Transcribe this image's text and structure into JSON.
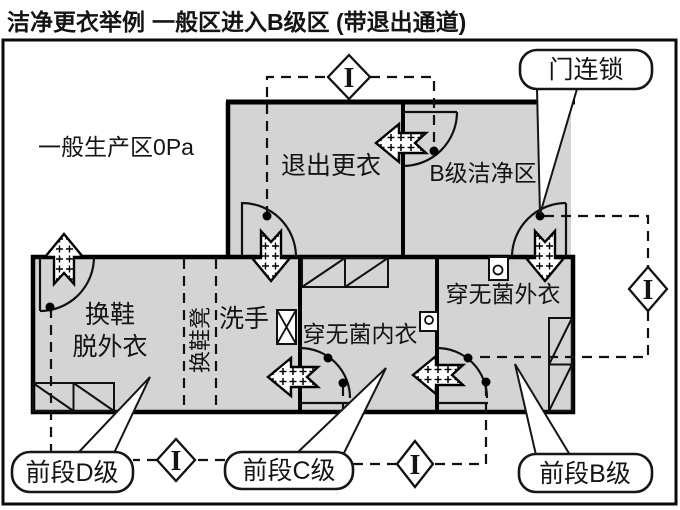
{
  "title": {
    "left": "洁净更衣举例",
    "right": "一般区进入B级区 (带退出通道)"
  },
  "colors": {
    "room_fill": "#d4d4d4",
    "wall": "#000000",
    "background": "#ffffff",
    "line": "#111111"
  },
  "zone_label": "一般生产区0Pa",
  "rooms": {
    "exit_changing": "退出更衣",
    "grade_b_clean_area": "B级洁净区",
    "change_shoes": "换鞋",
    "remove_outerwear": "脱外衣",
    "shoe_changing_bench": "换鞋凳",
    "wash_hands": "洗手",
    "wear_sterile_underwear": "穿无菌内衣",
    "wear_sterile_outerwear": "穿无菌外衣"
  },
  "callouts": {
    "door_interlock": "门连锁",
    "front_section_d": "前段D级",
    "front_section_c": "前段C级",
    "front_section_b": "前段B级"
  },
  "interlock_symbol": "I"
}
